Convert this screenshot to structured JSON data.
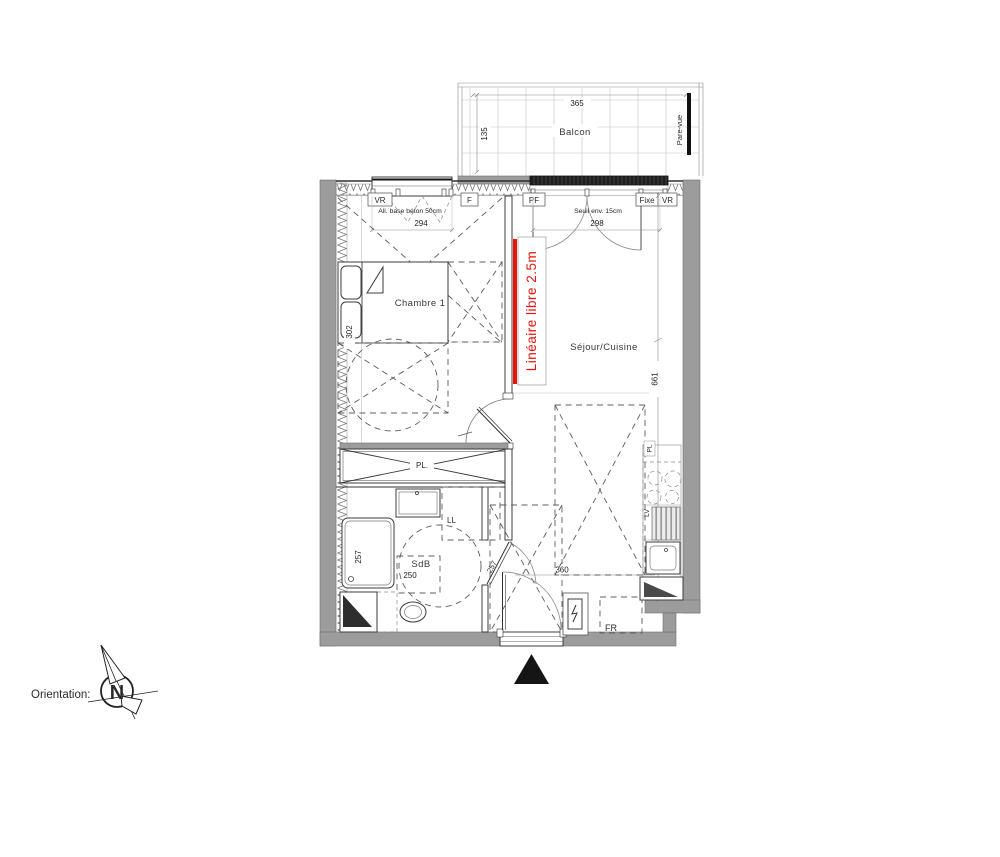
{
  "colors": {
    "wall": "#9c9c9c",
    "red": "#e8150d",
    "line": "#333333"
  },
  "balcony": {
    "label": "Balcon",
    "width_dim": "365",
    "depth_dim": "135",
    "screen_label": "Pare-vue"
  },
  "windows": {
    "bedroom": {
      "tag_left": "VR",
      "tag_right": "F",
      "note": "All. base béton 50cm",
      "dim": "294"
    },
    "living": {
      "tag_left": "PF",
      "tag_mid": "Fixe",
      "tag_right": "VR",
      "note": "Seuil env. 15cm",
      "dim": "298"
    }
  },
  "rooms": {
    "bedroom": {
      "label": "Chambre 1",
      "depth_dim": "302"
    },
    "living": {
      "label": "Séjour/Cuisine",
      "length_dim": "661",
      "width_dim": "360"
    },
    "bathroom": {
      "label": "SdB",
      "width_dim": "250",
      "shower_dim": "257",
      "door_dim": "257"
    }
  },
  "fixtures": {
    "closet": "PL.",
    "kitchen_tall_unit": "PL",
    "washing_machine": "LL",
    "dishwasher": "LV",
    "fridge": "FR"
  },
  "annotations": {
    "linear_free": "Linéaire libre 2.5m"
  },
  "compass": {
    "label": "Orientation:",
    "north": "N"
  }
}
